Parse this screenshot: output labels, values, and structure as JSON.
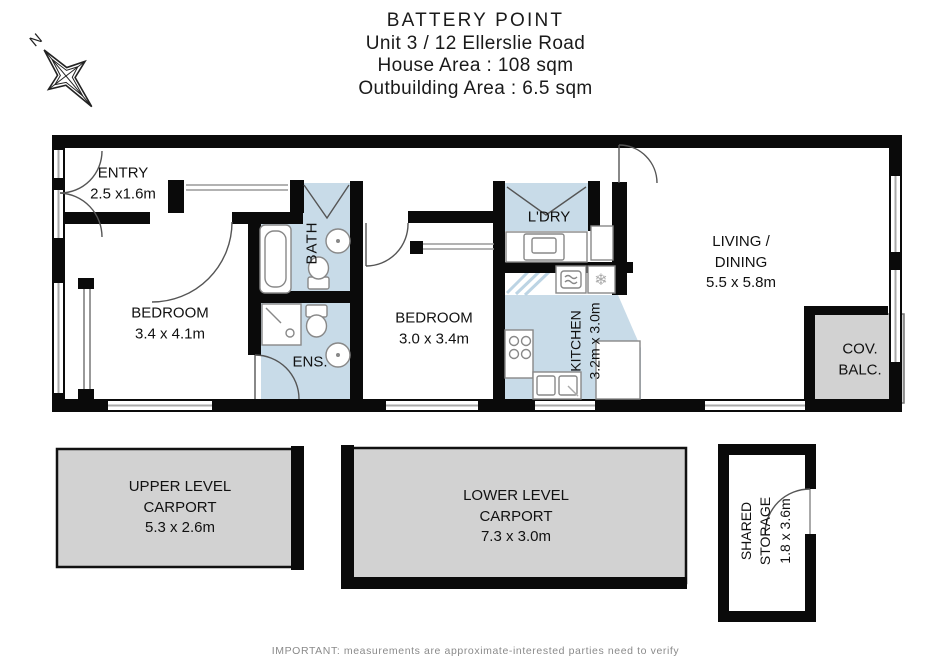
{
  "title": {
    "line1": "BATTERY POINT",
    "line2": "Unit 3 / 12 Ellerslie Road",
    "line3": "House Area : 108 sqm",
    "line4": "Outbuilding Area : 6.5 sqm"
  },
  "compass": {
    "north_label": "N"
  },
  "rooms": {
    "entry": {
      "name": "ENTRY",
      "dims": "2.5 x1.6m"
    },
    "bedroom1": {
      "name": "BEDROOM",
      "dims": "3.4 x 4.1m"
    },
    "bath": {
      "name": "BATH"
    },
    "ensuite": {
      "name": "ENS."
    },
    "bedroom2": {
      "name": "BEDROOM",
      "dims": "3.0 x 3.4m"
    },
    "laundry": {
      "name": "L'DRY"
    },
    "kitchen": {
      "name": "KITCHEN",
      "dims": "3.2m x 3.0m"
    },
    "living": {
      "name": "LIVING /",
      "name2": "DINING",
      "dims": "5.5 x 5.8m"
    },
    "balcony": {
      "name": "COV.",
      "name2": "BALC."
    }
  },
  "outbuildings": {
    "upper_carport": {
      "line1": "UPPER LEVEL",
      "line2": "CARPORT",
      "dims": "5.3 x 2.6m"
    },
    "lower_carport": {
      "line1": "LOWER LEVEL",
      "line2": "CARPORT",
      "dims": "7.3 x 3.0m"
    },
    "shared_storage": {
      "line1": "SHARED",
      "line2": "STORAGE",
      "dims": "1.8 x 3.6m"
    }
  },
  "footer": {
    "disclaimer": "IMPORTANT: measurements are approximate-interested parties need to verify"
  },
  "colors": {
    "wall": "#0a0a0a",
    "wet_area_blue": "#c8dbe8",
    "outdoor_gray": "#d2d2d2",
    "window_line": "#aaaaaa",
    "door_arc": "#555555"
  }
}
